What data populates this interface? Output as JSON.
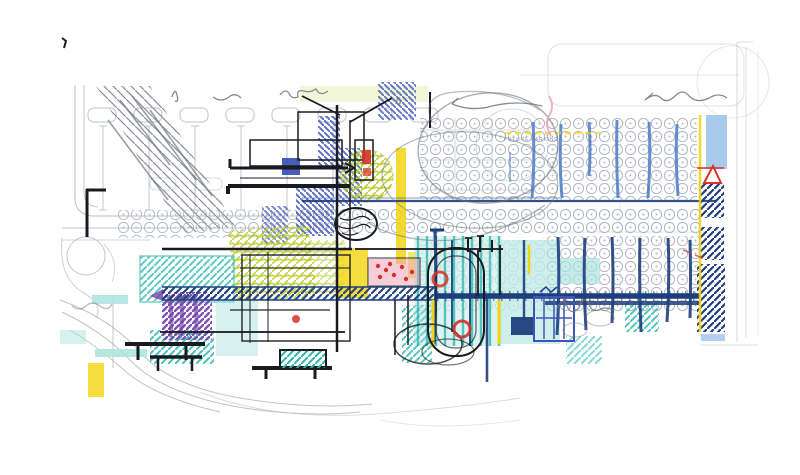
{
  "page": {
    "background": "#ffffff"
  },
  "sketch": {
    "kind": "architectural concept site-plan sketch",
    "annotation": {
      "future_area_label": "FUTURE PARKING"
    },
    "palette": {
      "pencil": "#aab0b9",
      "pencil_dark": "#70767f",
      "ink": "#1a1b20",
      "navy": "#1d3e7d",
      "royal": "#3d55b8",
      "marker_blue": "#4a7cc7",
      "sky_blue": "#9ec4ea",
      "teal": "#2ab5ad",
      "teal_light": "#aee4df",
      "yellow": "#f2d410",
      "chartreuse": "#b8cc2e",
      "purple": "#7340a8",
      "red": "#d6322a",
      "pink": "#ef9fb4",
      "label_blue": "#7d88a8"
    }
  }
}
